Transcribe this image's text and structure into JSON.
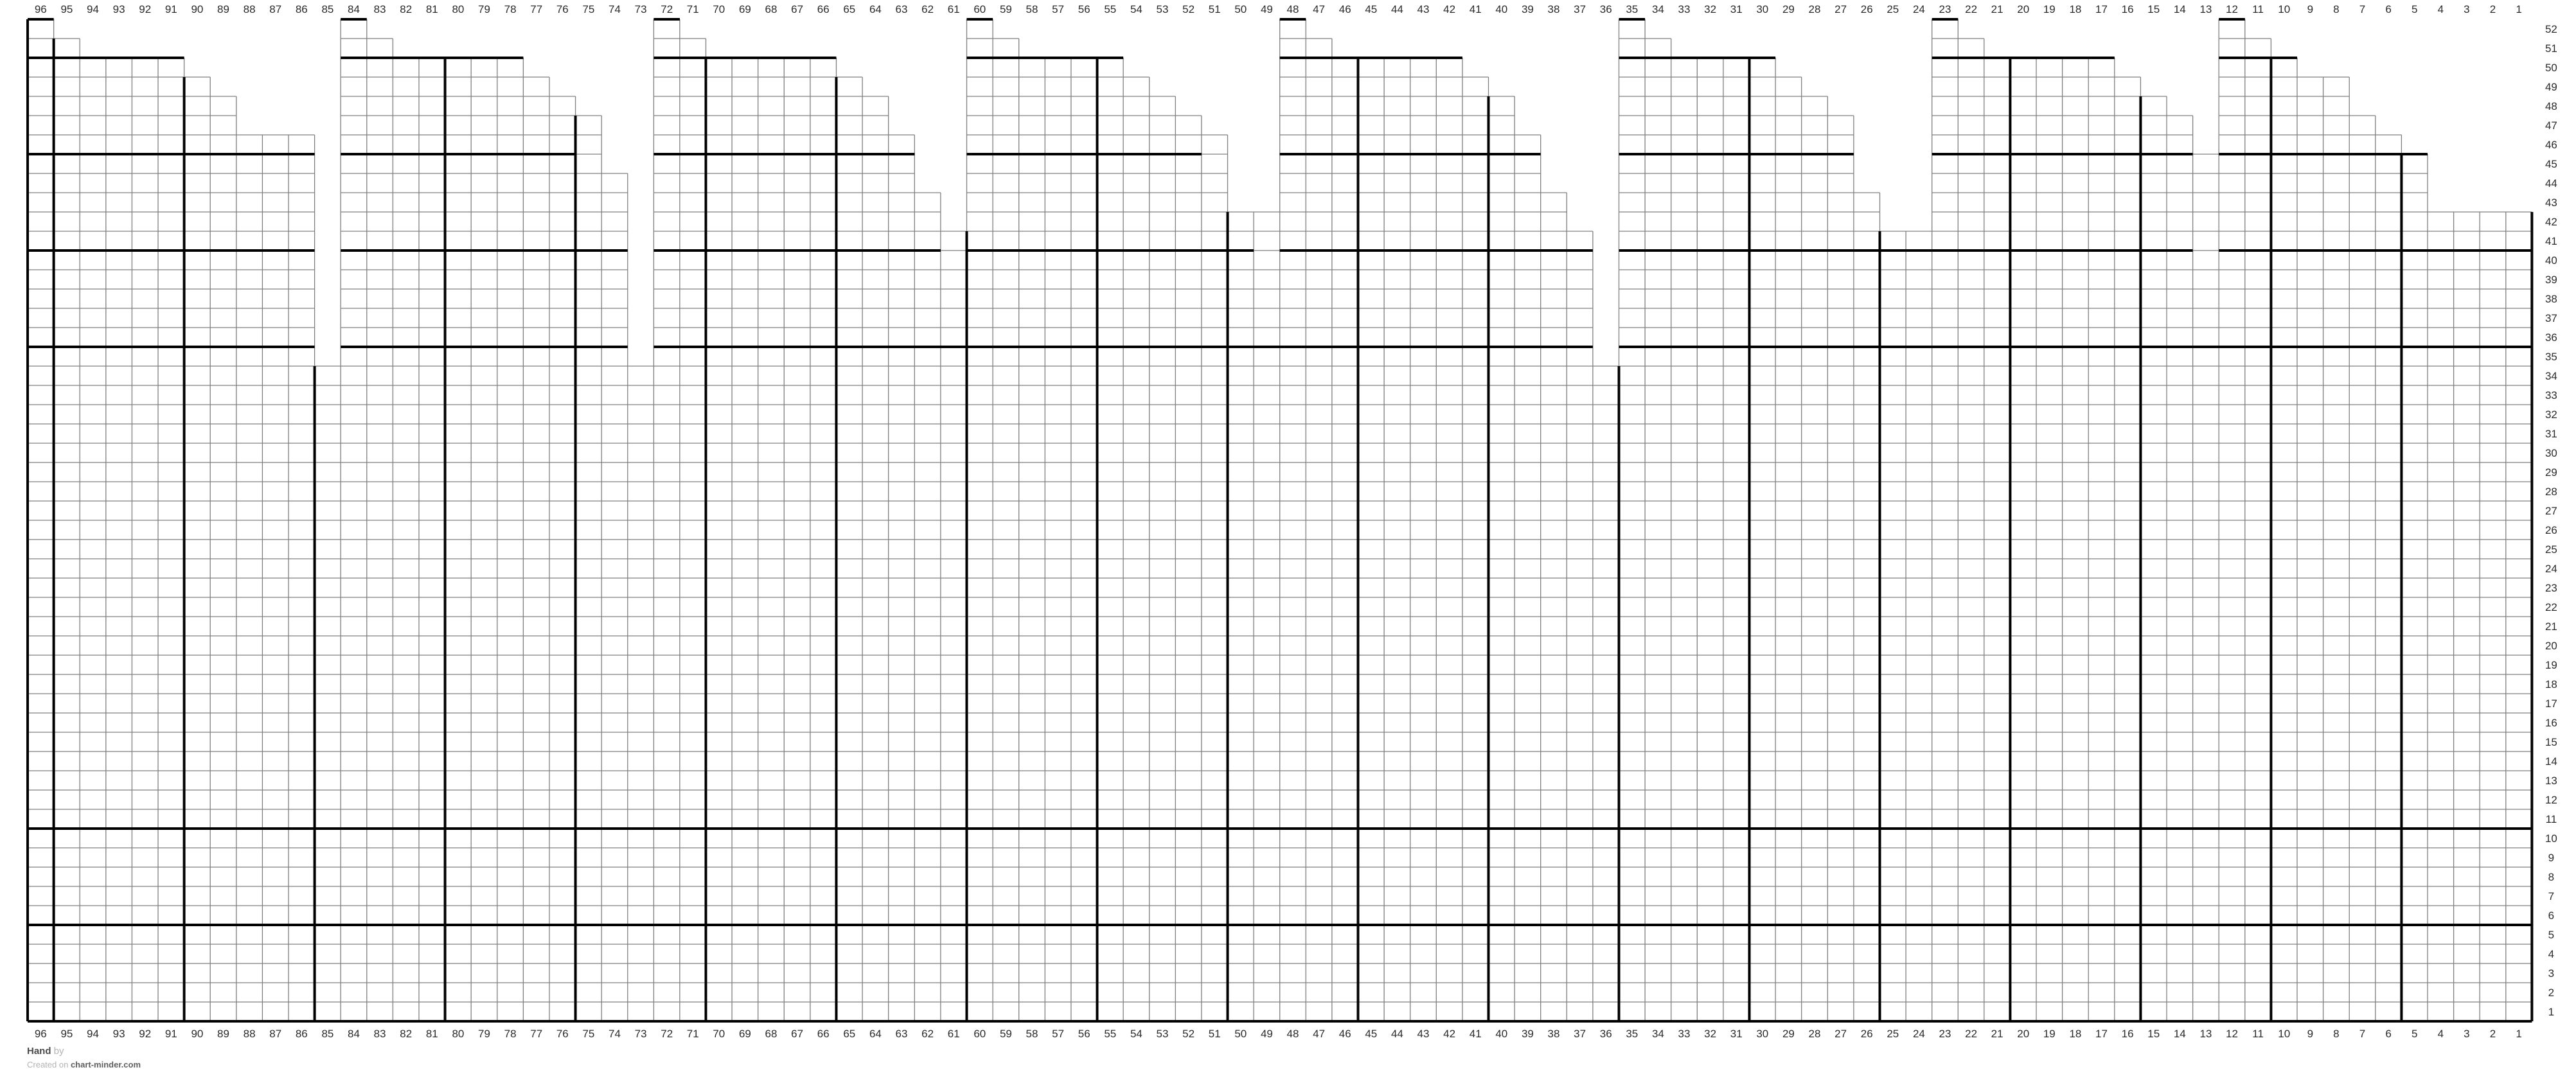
{
  "page": {
    "background": "#ffffff"
  },
  "colors": {
    "thin_line": "#7f7f7f",
    "step_line": "#aaaaaa",
    "bold_line": "#000000",
    "label_text": "#2b2b2b"
  },
  "footer": {
    "line1_dark": "Hand",
    "line1_light": " by",
    "line2_light": "Created on ",
    "line2_dark": "chart-minder.com"
  },
  "chart_data": {
    "type": "table",
    "subtype": "knitting-chart-grid",
    "columns": 96,
    "rows": 52,
    "column_labels": [
      "96",
      "95",
      "94",
      "93",
      "92",
      "91",
      "90",
      "89",
      "88",
      "87",
      "86",
      "85",
      "84",
      "83",
      "82",
      "81",
      "80",
      "79",
      "78",
      "77",
      "76",
      "75",
      "74",
      "73",
      "72",
      "71",
      "70",
      "69",
      "68",
      "67",
      "66",
      "65",
      "64",
      "63",
      "62",
      "61",
      "60",
      "59",
      "58",
      "57",
      "56",
      "55",
      "54",
      "53",
      "52",
      "51",
      "50",
      "49",
      "48",
      "47",
      "46",
      "45",
      "44",
      "43",
      "42",
      "41",
      "40",
      "39",
      "38",
      "37",
      "36",
      "35",
      "34",
      "33",
      "32",
      "31",
      "30",
      "29",
      "28",
      "27",
      "26",
      "25",
      "24",
      "23",
      "22",
      "21",
      "20",
      "19",
      "18",
      "17",
      "16",
      "15",
      "14",
      "13",
      "12",
      "11",
      "10",
      "9",
      "8",
      "7",
      "6",
      "5",
      "4",
      "3",
      "2",
      "1"
    ],
    "row_labels": [
      "52",
      "51",
      "50",
      "49",
      "48",
      "47",
      "46",
      "45",
      "44",
      "43",
      "42",
      "41",
      "40",
      "39",
      "38",
      "37",
      "36",
      "35",
      "34",
      "33",
      "32",
      "31",
      "30",
      "29",
      "28",
      "27",
      "26",
      "25",
      "24",
      "23",
      "22",
      "21",
      "20",
      "19",
      "18",
      "17",
      "16",
      "15",
      "14",
      "13",
      "12",
      "11",
      "10",
      "9",
      "8",
      "7",
      "6",
      "5",
      "4",
      "3",
      "2",
      "1"
    ],
    "column_start_row": {
      "96": 52,
      "95": 51,
      "94": 50,
      "93": 50,
      "92": 50,
      "91": 50,
      "90": 49,
      "89": 48,
      "88": 46,
      "87": 46,
      "86": 46,
      "85": 34,
      "84": 52,
      "83": 51,
      "82": 50,
      "81": 50,
      "80": 50,
      "79": 50,
      "78": 50,
      "77": 49,
      "76": 48,
      "75": 47,
      "74": 44,
      "73": 34,
      "72": 52,
      "71": 51,
      "70": 50,
      "69": 50,
      "68": 50,
      "67": 50,
      "66": 50,
      "65": 49,
      "64": 48,
      "63": 46,
      "62": 43,
      "61": 41,
      "60": 52,
      "59": 51,
      "58": 50,
      "57": 50,
      "56": 50,
      "55": 50,
      "54": 49,
      "53": 48,
      "52": 47,
      "51": 46,
      "50": 42,
      "49": 42,
      "48": 52,
      "47": 51,
      "46": 50,
      "45": 50,
      "44": 50,
      "43": 50,
      "42": 50,
      "41": 49,
      "40": 48,
      "39": 46,
      "38": 43,
      "37": 41,
      "36": 34,
      "35": 52,
      "34": 51,
      "33": 50,
      "32": 50,
      "31": 50,
      "30": 50,
      "29": 49,
      "28": 48,
      "27": 47,
      "26": 43,
      "25": 41,
      "24": 41,
      "23": 52,
      "22": 51,
      "21": 50,
      "20": 50,
      "19": 50,
      "18": 50,
      "17": 50,
      "16": 49,
      "15": 48,
      "14": 47,
      "13": 45,
      "12": 52,
      "11": 51,
      "10": 50,
      "9": 49,
      "8": 49,
      "7": 47,
      "6": 46,
      "5": 45,
      "4": 42,
      "3": 42,
      "2": 42,
      "1": 42
    },
    "bold_horizontals": [
      {
        "row": 52,
        "from": 96,
        "to": 96
      },
      {
        "row": 52,
        "from": 84,
        "to": 84
      },
      {
        "row": 52,
        "from": 72,
        "to": 72
      },
      {
        "row": 52,
        "from": 60,
        "to": 60
      },
      {
        "row": 52,
        "from": 48,
        "to": 48
      },
      {
        "row": 52,
        "from": 35,
        "to": 35
      },
      {
        "row": 52,
        "from": 23,
        "to": 23
      },
      {
        "row": 52,
        "from": 12,
        "to": 12
      },
      {
        "row": 50,
        "from": 96,
        "to": 91
      },
      {
        "row": 50,
        "from": 84,
        "to": 78
      },
      {
        "row": 50,
        "from": 72,
        "to": 66
      },
      {
        "row": 50,
        "from": 60,
        "to": 55
      },
      {
        "row": 50,
        "from": 48,
        "to": 42
      },
      {
        "row": 50,
        "from": 35,
        "to": 30
      },
      {
        "row": 50,
        "from": 23,
        "to": 17
      },
      {
        "row": 50,
        "from": 12,
        "to": 10
      },
      {
        "row": 45,
        "from": 96,
        "to": 86
      },
      {
        "row": 45,
        "from": 84,
        "to": 76
      },
      {
        "row": 45,
        "from": 72,
        "to": 63
      },
      {
        "row": 45,
        "from": 60,
        "to": 52
      },
      {
        "row": 45,
        "from": 48,
        "to": 39
      },
      {
        "row": 45,
        "from": 35,
        "to": 27
      },
      {
        "row": 45,
        "from": 23,
        "to": 14
      },
      {
        "row": 45,
        "from": 12,
        "to": 5
      },
      {
        "row": 40,
        "from": 96,
        "to": 86
      },
      {
        "row": 40,
        "from": 84,
        "to": 74
      },
      {
        "row": 40,
        "from": 72,
        "to": 62
      },
      {
        "row": 40,
        "from": 60,
        "to": 50
      },
      {
        "row": 40,
        "from": 48,
        "to": 37
      },
      {
        "row": 40,
        "from": 35,
        "to": 24
      },
      {
        "row": 40,
        "from": 23,
        "to": 14
      },
      {
        "row": 40,
        "from": 12,
        "to": 1
      },
      {
        "row": 35,
        "from": 96,
        "to": 86
      },
      {
        "row": 35,
        "from": 84,
        "to": 74
      },
      {
        "row": 35,
        "from": 72,
        "to": 61
      },
      {
        "row": 35,
        "from": 60,
        "to": 49
      },
      {
        "row": 35,
        "from": 48,
        "to": 37
      },
      {
        "row": 35,
        "from": 35,
        "to": 24
      },
      {
        "row": 35,
        "from": 23,
        "to": 13
      },
      {
        "row": 35,
        "from": 12,
        "to": 1
      },
      {
        "row": 10,
        "from": 96,
        "to": 1
      },
      {
        "row": 5,
        "from": 96,
        "to": 1
      }
    ],
    "bold_verticals": [
      {
        "b": 1,
        "from_row": 51
      },
      {
        "b": 6,
        "from_row": 49
      },
      {
        "b": 11,
        "from_row": 34
      },
      {
        "b": 16,
        "from_row": 50
      },
      {
        "b": 21,
        "from_row": 47
      },
      {
        "b": 26,
        "from_row": 50
      },
      {
        "b": 31,
        "from_row": 49
      },
      {
        "b": 36,
        "from_row": 41
      },
      {
        "b": 41,
        "from_row": 50
      },
      {
        "b": 46,
        "from_row": 42
      },
      {
        "b": 51,
        "from_row": 50
      },
      {
        "b": 56,
        "from_row": 48
      },
      {
        "b": 61,
        "from_row": 34
      },
      {
        "b": 66,
        "from_row": 50
      },
      {
        "b": 71,
        "from_row": 41
      },
      {
        "b": 76,
        "from_row": 50
      },
      {
        "b": 81,
        "from_row": 48
      },
      {
        "b": 86,
        "from_row": 50
      },
      {
        "b": 91,
        "from_row": 45
      }
    ],
    "outer_border": {
      "left_from_row": 52,
      "right_from_row": 42,
      "bottom": true
    }
  }
}
